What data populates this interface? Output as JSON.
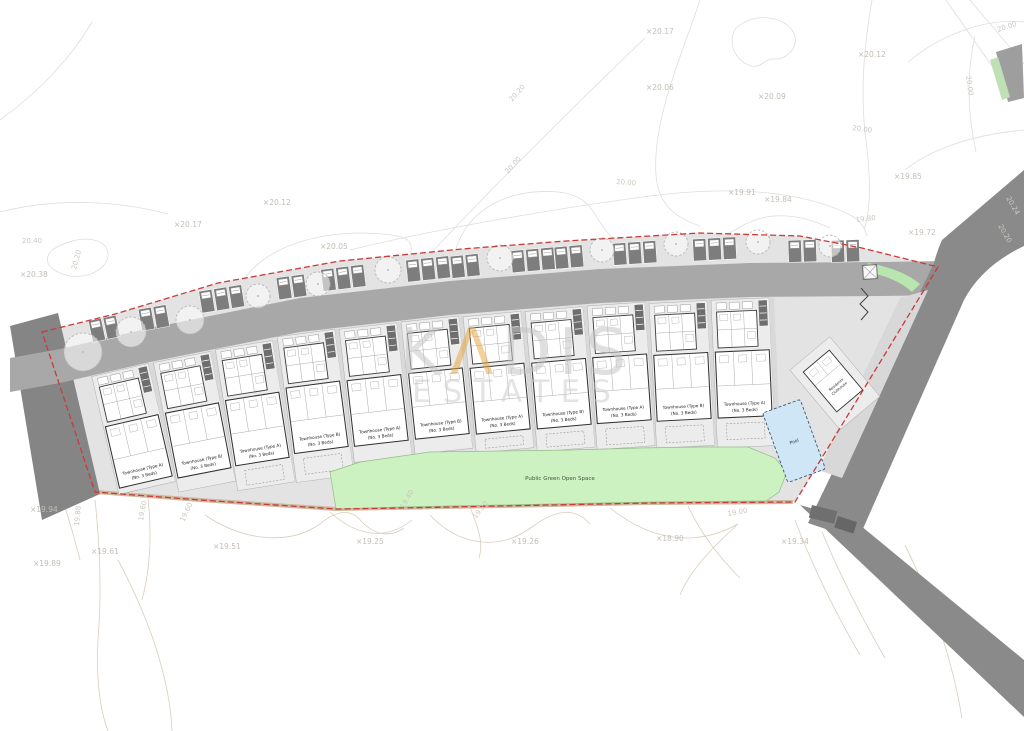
{
  "watermark": {
    "k": "K",
    "a": "Λ",
    "dis": "DIS",
    "estates": "ESTATES"
  },
  "labels": {
    "open_space": "Public Green Open Space",
    "pool": "Pool",
    "clubhouse_line1": "Residents",
    "clubhouse_line2": "Clubhouse"
  },
  "units": [
    {
      "cx": 120,
      "top": 370,
      "h": 121,
      "angle": -13,
      "name": "Townhouse (Type A)",
      "beds": "(No. 3 Beds)"
    },
    {
      "cx": 182,
      "top": 357,
      "h": 132,
      "angle": -11,
      "name": "Townhouse (Type B)",
      "beds": "(No. 3 Beds)"
    },
    {
      "cx": 244,
      "top": 345,
      "h": 143,
      "angle": -9,
      "name": "Townhouse (Type A)",
      "beds": "(No. 3 Beds)"
    },
    {
      "cx": 306,
      "top": 333,
      "h": 147,
      "angle": -7.5,
      "name": "Townhouse (Type B)",
      "beds": "(No. 3 Beds)"
    },
    {
      "cx": 368,
      "top": 326,
      "h": 134,
      "angle": -6.5,
      "name": "Townhouse (Type A)",
      "beds": "(No. 3 Beds)"
    },
    {
      "cx": 430,
      "top": 319,
      "h": 133,
      "angle": -6,
      "name": "Townhouse (Type B)",
      "beds": "(No. 3 Beds)"
    },
    {
      "cx": 492,
      "top": 314,
      "h": 137,
      "angle": -5.5,
      "name": "Townhouse (Type A)",
      "beds": "(No. 3 Beds)"
    },
    {
      "cx": 554,
      "top": 309,
      "h": 141,
      "angle": -5,
      "name": "Townhouse (Type B)",
      "beds": "(No. 3 Beds)"
    },
    {
      "cx": 616,
      "top": 304,
      "h": 144,
      "angle": -4,
      "name": "Townhouse (Type A)",
      "beds": "(No. 3 Beds)"
    },
    {
      "cx": 678,
      "top": 302,
      "h": 145,
      "angle": -3,
      "name": "Townhouse (Type B)",
      "beds": "(No. 3 Beds)"
    },
    {
      "cx": 740,
      "top": 299,
      "h": 148,
      "angle": -2.5,
      "name": "Townhouse (Type A)",
      "beds": "(No. 3 Beds)"
    }
  ],
  "spot_elevations": [
    {
      "t": "×20.17",
      "x": 646,
      "y": 34
    },
    {
      "t": "×20.06",
      "x": 646,
      "y": 90
    },
    {
      "t": "×20.09",
      "x": 758,
      "y": 99
    },
    {
      "t": "×20.12",
      "x": 858,
      "y": 57
    },
    {
      "t": "×20.12",
      "x": 263,
      "y": 205
    },
    {
      "t": "×20.05",
      "x": 320,
      "y": 249
    },
    {
      "t": "×20.17",
      "x": 174,
      "y": 227
    },
    {
      "t": "×20.38",
      "x": 20,
      "y": 277
    },
    {
      "t": "×19.85",
      "x": 894,
      "y": 179
    },
    {
      "t": "×19.91",
      "x": 728,
      "y": 195
    },
    {
      "t": "×19.84",
      "x": 764,
      "y": 202
    },
    {
      "t": "×19.72",
      "x": 908,
      "y": 235
    },
    {
      "t": "×19.94",
      "x": 30,
      "y": 512
    },
    {
      "t": "×19.89",
      "x": 33,
      "y": 566
    },
    {
      "t": "×19.61",
      "x": 91,
      "y": 554
    },
    {
      "t": "×19.51",
      "x": 213,
      "y": 549
    },
    {
      "t": "×19.25",
      "x": 356,
      "y": 544
    },
    {
      "t": "×19.26",
      "x": 511,
      "y": 544
    },
    {
      "t": "×18.90",
      "x": 656,
      "y": 541
    },
    {
      "t": "×19.34",
      "x": 781,
      "y": 544
    }
  ],
  "contour_labels": [
    {
      "t": "20.40",
      "x": 22,
      "y": 243,
      "r": 0
    },
    {
      "t": "20.20",
      "x": 76,
      "y": 270,
      "r": -75
    },
    {
      "t": "20.20",
      "x": 512,
      "y": 102,
      "r": -48
    },
    {
      "t": "20.00",
      "x": 508,
      "y": 174,
      "r": -48
    },
    {
      "t": "20.00",
      "x": 616,
      "y": 184,
      "r": 4
    },
    {
      "t": "20.00",
      "x": 998,
      "y": 32,
      "r": -18
    },
    {
      "t": "20.00",
      "x": 966,
      "y": 76,
      "r": 82
    },
    {
      "t": "20.00",
      "x": 852,
      "y": 130,
      "r": 8
    },
    {
      "t": "19.80",
      "x": 856,
      "y": 222,
      "r": -6
    },
    {
      "t": "20.24",
      "x": 1006,
      "y": 198,
      "r": 60
    },
    {
      "t": "20.20",
      "x": 998,
      "y": 226,
      "r": 60
    },
    {
      "t": "19.88",
      "x": 79,
      "y": 526,
      "r": -85
    },
    {
      "t": "19.60",
      "x": 143,
      "y": 521,
      "r": -80
    },
    {
      "t": "19.60",
      "x": 184,
      "y": 522,
      "r": -65
    },
    {
      "t": "19.40",
      "x": 404,
      "y": 509,
      "r": -60
    },
    {
      "t": "19.20",
      "x": 476,
      "y": 519,
      "r": -52
    },
    {
      "t": "19.00",
      "x": 728,
      "y": 516,
      "r": -10
    }
  ],
  "trees": [
    {
      "x": 83,
      "y": 352,
      "r": 19
    },
    {
      "x": 131,
      "y": 332,
      "r": 15
    },
    {
      "x": 190,
      "y": 320,
      "r": 14
    },
    {
      "x": 258,
      "y": 296,
      "r": 12
    },
    {
      "x": 318,
      "y": 284,
      "r": 12
    },
    {
      "x": 388,
      "y": 270,
      "r": 13
    },
    {
      "x": 500,
      "y": 258,
      "r": 13
    },
    {
      "x": 602,
      "y": 250,
      "r": 12
    },
    {
      "x": 676,
      "y": 244,
      "r": 12
    },
    {
      "x": 758,
      "y": 242,
      "r": 12
    },
    {
      "x": 830,
      "y": 246,
      "r": 11
    }
  ],
  "parking_groups": [
    {
      "x": 102,
      "y": 318,
      "a": -12,
      "n": 2
    },
    {
      "x": 152,
      "y": 307,
      "a": -10,
      "n": 2
    },
    {
      "x": 220,
      "y": 288,
      "a": -9,
      "n": 3
    },
    {
      "x": 290,
      "y": 276,
      "a": -8,
      "n": 2
    },
    {
      "x": 342,
      "y": 267,
      "a": -7,
      "n": 3
    },
    {
      "x": 427,
      "y": 258,
      "a": -6,
      "n": 3
    },
    {
      "x": 464,
      "y": 255,
      "a": -6,
      "n": 2
    },
    {
      "x": 532,
      "y": 249,
      "a": -5,
      "n": 3
    },
    {
      "x": 568,
      "y": 246,
      "a": -5,
      "n": 2
    },
    {
      "x": 634,
      "y": 242,
      "a": -4,
      "n": 3
    },
    {
      "x": 714,
      "y": 238,
      "a": -3,
      "n": 3
    },
    {
      "x": 802,
      "y": 240,
      "a": -2,
      "n": 2
    },
    {
      "x": 845,
      "y": 240,
      "a": -2,
      "n": 2
    }
  ],
  "colors": {
    "boundary": "#cc3a3a",
    "green_space": "#cdf2c2",
    "pool": "#cfe6f6",
    "road_dark": "#8a8a8a",
    "road_light": "#a8a8a8",
    "watermark_accent": "#e6a53f"
  }
}
